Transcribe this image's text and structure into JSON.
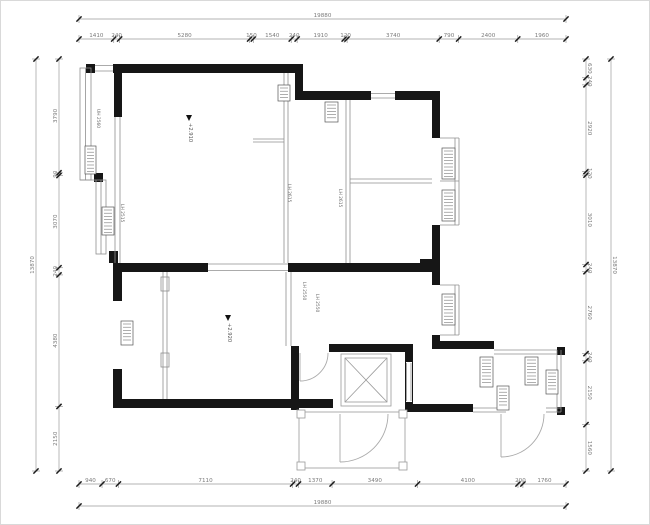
{
  "dimensions": {
    "top": {
      "total": "19880",
      "segments": [
        "1410",
        "240",
        "5280",
        "150",
        "1540",
        "240",
        "1910",
        "120",
        "3740",
        "790",
        "2400",
        "1960"
      ]
    },
    "bottom": {
      "total": "19880",
      "segments": [
        "940",
        "670",
        "7110",
        "240",
        "1370",
        "3490",
        "4100",
        "200",
        "1760"
      ]
    },
    "left": {
      "total": "13870",
      "segments": [
        "3790",
        "90",
        "3070",
        "240",
        "4380",
        "2150"
      ]
    },
    "right": {
      "total": "13870",
      "segments": [
        "630",
        "240",
        "2920",
        "120",
        "3010",
        "240",
        "2760",
        "240",
        "2150",
        "1560"
      ]
    }
  },
  "plan_labels": {
    "level_markers": [
      "+2.910",
      "+2.920"
    ],
    "height_labels": [
      "UH 2560",
      "LH 2515",
      "LH 2615",
      "LH 2615",
      "LH 2550",
      "LH 2550"
    ]
  },
  "icons": {
    "level_marker": "flag-triangle-icon",
    "elevator_shaft": "crossed-box-icon",
    "window_tag": "hatched-schedule-tag-icon",
    "dimension_tick": "oblique-slash-tick-icon"
  },
  "colors": {
    "walls": "#161616",
    "thin_lines": "#8f8f8f",
    "dimension_lines": "#9a9a9a",
    "dimension_text": "#7a7a7a",
    "background": "#ffffff"
  }
}
